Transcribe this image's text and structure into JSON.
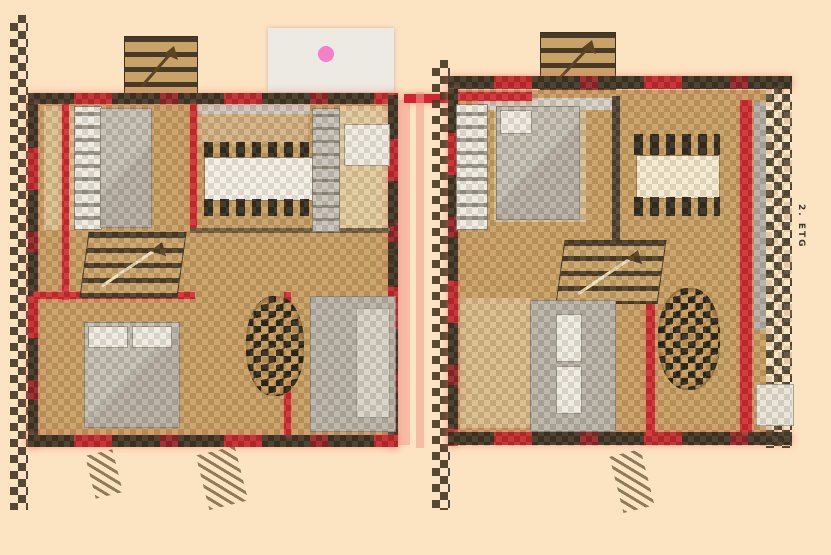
{
  "palette": {
    "background": "#fce4c2",
    "wall_red": "#cf2730",
    "wall_dark": "#3a3022",
    "floor_tan": "#c79e63",
    "furniture_gray": "#b7b2a9",
    "terrace_gray": "#eceae2",
    "accent_pink": "#f57fc8"
  },
  "plans": {
    "left": {
      "label": "1. ETG"
    },
    "right": {
      "label": "2. ETG"
    }
  },
  "icons": {
    "stair_direction": "stairs-arrow-icon",
    "exit_mark": "plant-scribble"
  }
}
